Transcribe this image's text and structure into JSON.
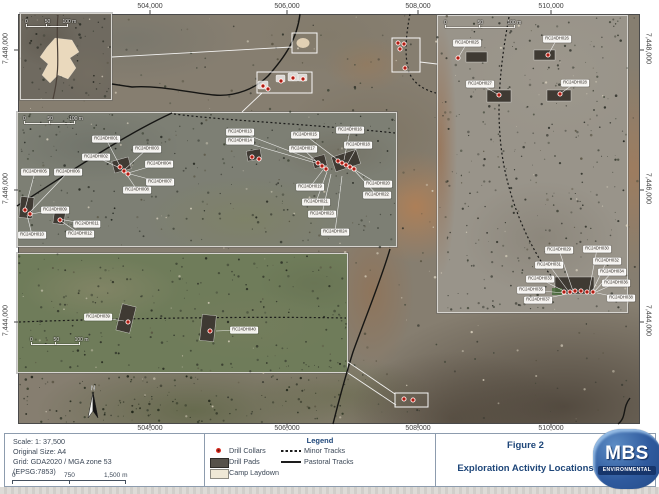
{
  "title_block": {
    "figure_label": "Figure 2",
    "title": "Exploration Activity Locations"
  },
  "logo": {
    "text": "MBS",
    "subtext": "ENVIRONMENTAL"
  },
  "north_label": "N",
  "colors": {
    "accent_navy": "#1e4679",
    "collar_red": "#d92b1f",
    "pad_gray": "#3f3a33",
    "camp_cream": "#ead9bd",
    "logo_blue": "#2f5a9e"
  },
  "scale_info": {
    "lines": [
      "Scale: 1: 37,500",
      "Original Size: A4",
      "Grid: GDA2020 / MGA zone 53",
      "(EPSG:7853)"
    ],
    "bar_labels": {
      "start": "0",
      "mid": "750",
      "end": "1,500 m"
    }
  },
  "legend": {
    "title": "Legend",
    "items_left": [
      {
        "symbol": "drill-collar",
        "label": "Drill Collars"
      },
      {
        "symbol": "drill-pad",
        "label": "Drill Pads"
      },
      {
        "symbol": "camp-laydown",
        "label": "Camp Laydown"
      }
    ],
    "items_right": [
      {
        "symbol": "minor-track",
        "label": "Minor Tracks"
      },
      {
        "symbol": "pastoral-track",
        "label": "Pastoral Tracks"
      }
    ]
  },
  "grid": {
    "top": [
      {
        "label": "504,000",
        "x": 150
      },
      {
        "label": "506,000",
        "x": 287
      },
      {
        "label": "508,000",
        "x": 418
      },
      {
        "label": "510,000",
        "x": 551
      }
    ],
    "bottom": [
      {
        "label": "504,000",
        "x": 150
      },
      {
        "label": "506,000",
        "x": 287
      },
      {
        "label": "508,000",
        "x": 418
      },
      {
        "label": "510,000",
        "x": 551
      }
    ],
    "left": [
      {
        "label": "7,448,000",
        "y": 50
      },
      {
        "label": "7,446,000",
        "y": 190
      },
      {
        "label": "7,444,000",
        "y": 322
      }
    ],
    "right": [
      {
        "label": "7,448,000",
        "y": 50
      },
      {
        "label": "7,446,000",
        "y": 190
      },
      {
        "label": "7,444,000",
        "y": 322
      }
    ]
  },
  "inset_scalebars": [
    {
      "x": 25,
      "y": 19,
      "w": 52,
      "labels": [
        "0",
        "50",
        "100 m"
      ]
    },
    {
      "x": 23,
      "y": 116,
      "w": 64,
      "labels": [
        "0",
        "50",
        "100 m"
      ]
    },
    {
      "x": 30,
      "y": 337,
      "w": 62,
      "labels": [
        "0",
        "50",
        "100 m"
      ]
    },
    {
      "x": 444,
      "y": 20,
      "w": 88,
      "labels": [
        "0",
        "50",
        "100 m"
      ]
    }
  ],
  "drill_labels": [
    {
      "t": "RC24DH001",
      "x": 106,
      "y": 139,
      "tx": 120,
      "ty": 166
    },
    {
      "t": "RC24DH002",
      "x": 96,
      "y": 157,
      "tx": 120,
      "ty": 168
    },
    {
      "t": "RC24DH003",
      "x": 147,
      "y": 149,
      "tx": 124,
      "ty": 170
    },
    {
      "t": "RC24DH004",
      "x": 159,
      "y": 164,
      "tx": 128,
      "ty": 173
    },
    {
      "t": "RC24DH005",
      "x": 35,
      "y": 172,
      "tx": 25,
      "ty": 209
    },
    {
      "t": "RC24DH006",
      "x": 68,
      "y": 172,
      "tx": 30,
      "ty": 212
    },
    {
      "t": "RC24DH007",
      "x": 160,
      "y": 182,
      "tx": 130,
      "ty": 174
    },
    {
      "t": "RC24DH008",
      "x": 137,
      "y": 190,
      "tx": 127,
      "ty": 175
    },
    {
      "t": "RC24DH009",
      "x": 55,
      "y": 210,
      "tx": 31,
      "ty": 214
    },
    {
      "t": "RC24DH010",
      "x": 32,
      "y": 235,
      "tx": 27,
      "ty": 215
    },
    {
      "t": "RC24DH011",
      "x": 87,
      "y": 224,
      "tx": 59,
      "ty": 219
    },
    {
      "t": "RC24DH012",
      "x": 80,
      "y": 234,
      "tx": 61,
      "ty": 221
    },
    {
      "t": "RC24DH013",
      "x": 240,
      "y": 132,
      "tx": 318,
      "ty": 162
    },
    {
      "t": "RC24DH014",
      "x": 240,
      "y": 141,
      "tx": 319,
      "ty": 164
    },
    {
      "t": "RC24DH015",
      "x": 305,
      "y": 135,
      "tx": 338,
      "ty": 160
    },
    {
      "t": "RC24DH016",
      "x": 350,
      "y": 130,
      "tx": 344,
      "ty": 160
    },
    {
      "t": "RC24DH017",
      "x": 303,
      "y": 149,
      "tx": 321,
      "ty": 166
    },
    {
      "t": "RC24DH018",
      "x": 358,
      "y": 145,
      "tx": 348,
      "ty": 163
    },
    {
      "t": "RC24DH019",
      "x": 310,
      "y": 187,
      "tx": 323,
      "ty": 170
    },
    {
      "t": "RC24DH020",
      "x": 378,
      "y": 184,
      "tx": 352,
      "ty": 168
    },
    {
      "t": "RC24DH021",
      "x": 316,
      "y": 202,
      "tx": 327,
      "ty": 172
    },
    {
      "t": "RC24DH022",
      "x": 377,
      "y": 195,
      "tx": 354,
      "ty": 170
    },
    {
      "t": "RC24DH023",
      "x": 322,
      "y": 214,
      "tx": 331,
      "ty": 174
    },
    {
      "t": "RC24DH024",
      "x": 335,
      "y": 232,
      "tx": 342,
      "ty": 176
    },
    {
      "t": "RC24DH025",
      "x": 467,
      "y": 43,
      "tx": 458,
      "ty": 58
    },
    {
      "t": "RC24DH026",
      "x": 557,
      "y": 39,
      "tx": 548,
      "ty": 55
    },
    {
      "t": "RC24DH027",
      "x": 480,
      "y": 84,
      "tx": 499,
      "ty": 95
    },
    {
      "t": "RC24DH028",
      "x": 575,
      "y": 83,
      "tx": 560,
      "ty": 94
    },
    {
      "t": "RC24DH029",
      "x": 559,
      "y": 250,
      "tx": 573,
      "ty": 291
    },
    {
      "t": "RC24DH030",
      "x": 597,
      "y": 249,
      "tx": 589,
      "ty": 291
    },
    {
      "t": "RC24DH031",
      "x": 549,
      "y": 265,
      "tx": 569,
      "ty": 292
    },
    {
      "t": "RC24DH032",
      "x": 607,
      "y": 261,
      "tx": 592,
      "ty": 292
    },
    {
      "t": "RC24DH033",
      "x": 540,
      "y": 279,
      "tx": 566,
      "ty": 292
    },
    {
      "t": "RC24DH034",
      "x": 612,
      "y": 272,
      "tx": 594,
      "ty": 292
    },
    {
      "t": "RC24DH035",
      "x": 531,
      "y": 290,
      "tx": 564,
      "ty": 293
    },
    {
      "t": "RC24DH036",
      "x": 616,
      "y": 283,
      "tx": 596,
      "ty": 292
    },
    {
      "t": "RC24DH037",
      "x": 538,
      "y": 300,
      "tx": 567,
      "ty": 294
    },
    {
      "t": "RC24DH038",
      "x": 621,
      "y": 298,
      "tx": 597,
      "ty": 293
    },
    {
      "t": "RC24DH039",
      "x": 98,
      "y": 317,
      "tx": 124,
      "ty": 321
    },
    {
      "t": "RC24DH040",
      "x": 244,
      "y": 330,
      "tx": 216,
      "ty": 331
    }
  ],
  "drill_collars": [
    [
      120,
      167
    ],
    [
      124,
      171
    ],
    [
      128,
      174
    ],
    [
      318,
      163
    ],
    [
      322,
      166
    ],
    [
      326,
      169
    ],
    [
      338,
      161
    ],
    [
      342,
      163
    ],
    [
      346,
      165
    ],
    [
      350,
      167
    ],
    [
      354,
      169
    ],
    [
      252,
      157
    ],
    [
      259,
      159
    ],
    [
      25,
      210
    ],
    [
      30,
      214
    ],
    [
      60,
      220
    ],
    [
      458,
      58
    ],
    [
      548,
      55
    ],
    [
      499,
      95
    ],
    [
      560,
      94
    ],
    [
      564,
      292
    ],
    [
      570,
      292
    ],
    [
      575,
      291
    ],
    [
      581,
      291
    ],
    [
      587,
      292
    ],
    [
      593,
      292
    ],
    [
      128,
      322
    ],
    [
      210,
      331
    ],
    [
      263,
      86
    ],
    [
      268,
      89
    ],
    [
      281,
      81
    ],
    [
      293,
      78
    ],
    [
      303,
      79
    ],
    [
      398,
      43
    ],
    [
      404,
      44
    ],
    [
      400,
      49
    ],
    [
      405,
      68
    ],
    [
      404,
      399
    ],
    [
      413,
      400
    ]
  ],
  "drill_pads": [
    [
      333,
      153,
      26,
      15,
      -18
    ],
    [
      113,
      159,
      17,
      12,
      -15
    ],
    [
      20,
      197,
      13,
      21,
      6
    ],
    [
      54,
      207,
      11,
      17,
      8
    ],
    [
      247,
      150,
      14,
      10,
      -10
    ],
    [
      313,
      156,
      13,
      11,
      -15
    ],
    [
      466,
      52,
      21,
      10,
      0
    ],
    [
      534,
      50,
      21,
      10,
      0
    ],
    [
      487,
      90,
      24,
      12,
      0
    ],
    [
      547,
      90,
      24,
      11,
      0
    ],
    [
      555,
      277,
      39,
      17,
      0
    ],
    [
      119,
      305,
      14,
      27,
      14
    ],
    [
      201,
      315,
      14,
      26,
      6
    ]
  ],
  "white_pads": [
    [
      258,
      81,
      10,
      8
    ],
    [
      276,
      75,
      9,
      7
    ],
    [
      288,
      73,
      10,
      8
    ],
    [
      298,
      74,
      9,
      7
    ]
  ],
  "callout_boxes": [
    [
      292,
      33,
      25,
      20
    ],
    [
      257,
      72,
      55,
      21
    ],
    [
      392,
      38,
      28,
      34
    ],
    [
      395,
      393,
      33,
      14
    ]
  ],
  "connectors": [
    [
      112,
      57,
      292,
      47
    ],
    [
      262,
      93,
      242,
      112
    ],
    [
      420,
      62,
      437,
      64
    ],
    [
      348,
      362,
      395,
      394
    ],
    [
      348,
      373,
      396,
      405
    ]
  ]
}
